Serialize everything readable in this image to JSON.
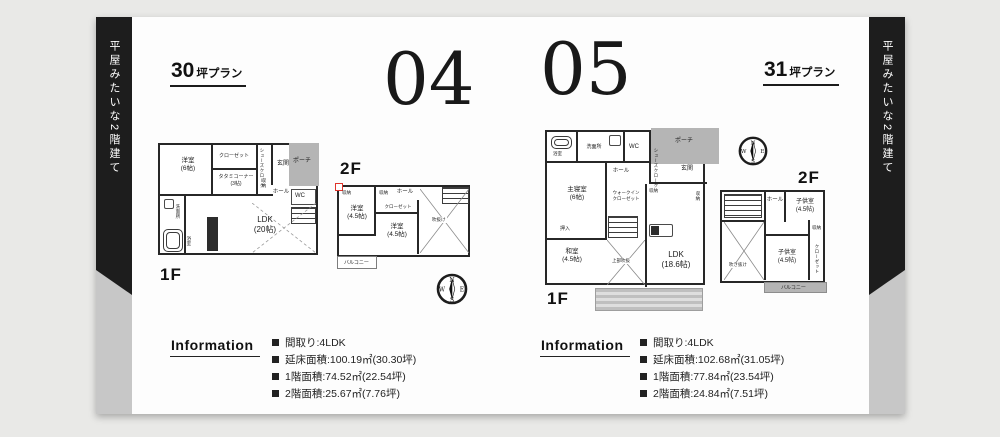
{
  "banner": "平屋みたいな2階建て",
  "compass": {
    "n": "N",
    "e": "E",
    "s": "S",
    "w": "W"
  },
  "plan04": {
    "number": "04",
    "tsubo_big": "30",
    "tsubo_small": "坪プラン",
    "f1": {
      "label": "1F",
      "rooms": {
        "yoshitsu": [
          "洋室",
          "(6帖)"
        ],
        "closet": "クローゼット",
        "shoes": "シューズクローク",
        "tatami": [
          "タタミコーナー",
          "(3帖)"
        ],
        "genkan": "玄関",
        "porch": "ポーチ",
        "hall": "ホール",
        "wc": "WC",
        "shunou": "収納",
        "ldk": [
          "LDK",
          "(20帖)"
        ],
        "senmen": "洗面所",
        "bath": "浴室"
      }
    },
    "f2": {
      "label": "2F",
      "rooms": {
        "hall": "ホール",
        "yoshitsu1": [
          "洋室",
          "(4.5帖)"
        ],
        "yoshitsu2": [
          "洋室",
          "(4.5帖)"
        ],
        "closet": "クローゼット",
        "shunou1": "収納",
        "shunou2": "収納",
        "void": "吹抜け",
        "balcony": "バルコニー"
      }
    },
    "info": {
      "heading": "Information",
      "items": [
        "間取り:4LDK",
        "延床面積:100.19㎡(30.30坪)",
        "1階面積:74.52㎡(22.54坪)",
        "2階面積:25.67㎡(7.76坪)"
      ]
    }
  },
  "plan05": {
    "number": "05",
    "tsubo_big": "31",
    "tsubo_small": "坪プラン",
    "f1": {
      "label": "1F",
      "rooms": {
        "bath": "浴室",
        "senmen": "洗面所",
        "wc": "WC",
        "porch": "ポーチ",
        "shoes": "シューズクローク",
        "genkan": "玄関",
        "hall": "ホール",
        "master": [
          "主寝室",
          "(6帖)"
        ],
        "wic": [
          "ウォークイン",
          "クローゼット"
        ],
        "shunou1": "収納",
        "shunou2": "収納",
        "oshiire": "押入",
        "washitsu": [
          "和室",
          "(4.5帖)"
        ],
        "void": "上部吹抜",
        "ldk": [
          "LDK",
          "(18.6帖)"
        ]
      }
    },
    "f2": {
      "label": "2F",
      "rooms": {
        "hall": "ホール",
        "kids1": [
          "子供室",
          "(4.5帖)"
        ],
        "kids2": [
          "子供室",
          "(4.5帖)"
        ],
        "shunou": "収納",
        "closet": "クローゼット",
        "void": "吹き抜け",
        "balcony": "バルコニー"
      }
    },
    "info": {
      "heading": "Information",
      "items": [
        "間取り:4LDK",
        "延床面積:102.68㎡(31.05坪)",
        "1階面積:77.84㎡(23.54坪)",
        "2階面積:24.84㎡(7.51坪)"
      ]
    }
  }
}
